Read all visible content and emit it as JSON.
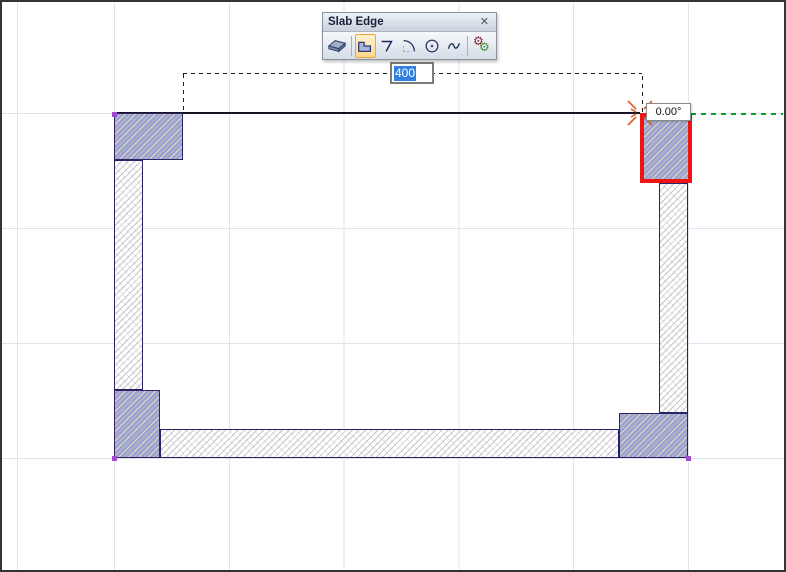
{
  "toolbar": {
    "title": "Slab Edge",
    "close_label": "✕",
    "buttons": [
      {
        "icon": "slab-icon",
        "selected": false
      },
      {
        "icon": "pick-polygon-icon",
        "selected": true
      },
      {
        "icon": "pick-polyline-icon",
        "selected": false
      },
      {
        "icon": "pick-arc-icon",
        "selected": false
      },
      {
        "icon": "pick-circle-icon",
        "selected": false
      },
      {
        "icon": "pick-curve-icon",
        "selected": false
      },
      {
        "icon": "gears-icon",
        "selected": false
      }
    ]
  },
  "canvas": {
    "dimension_input": {
      "value": "400",
      "text_selected": true
    },
    "angle_tooltip": {
      "text": "0.00°"
    }
  },
  "colors": {
    "column_fill": "#9da0d2",
    "wall_fill": "#ffffff",
    "entity_outline": "#2b2164",
    "selected_outline_red": "#ed1414",
    "guide_green": "#0aa32a",
    "snap_marker_orange": "#e0591f",
    "vertex_handle_purple": "#a24ad0",
    "text_selection_blue": "#2f80e0",
    "grid_line": "#e2e2ee"
  }
}
